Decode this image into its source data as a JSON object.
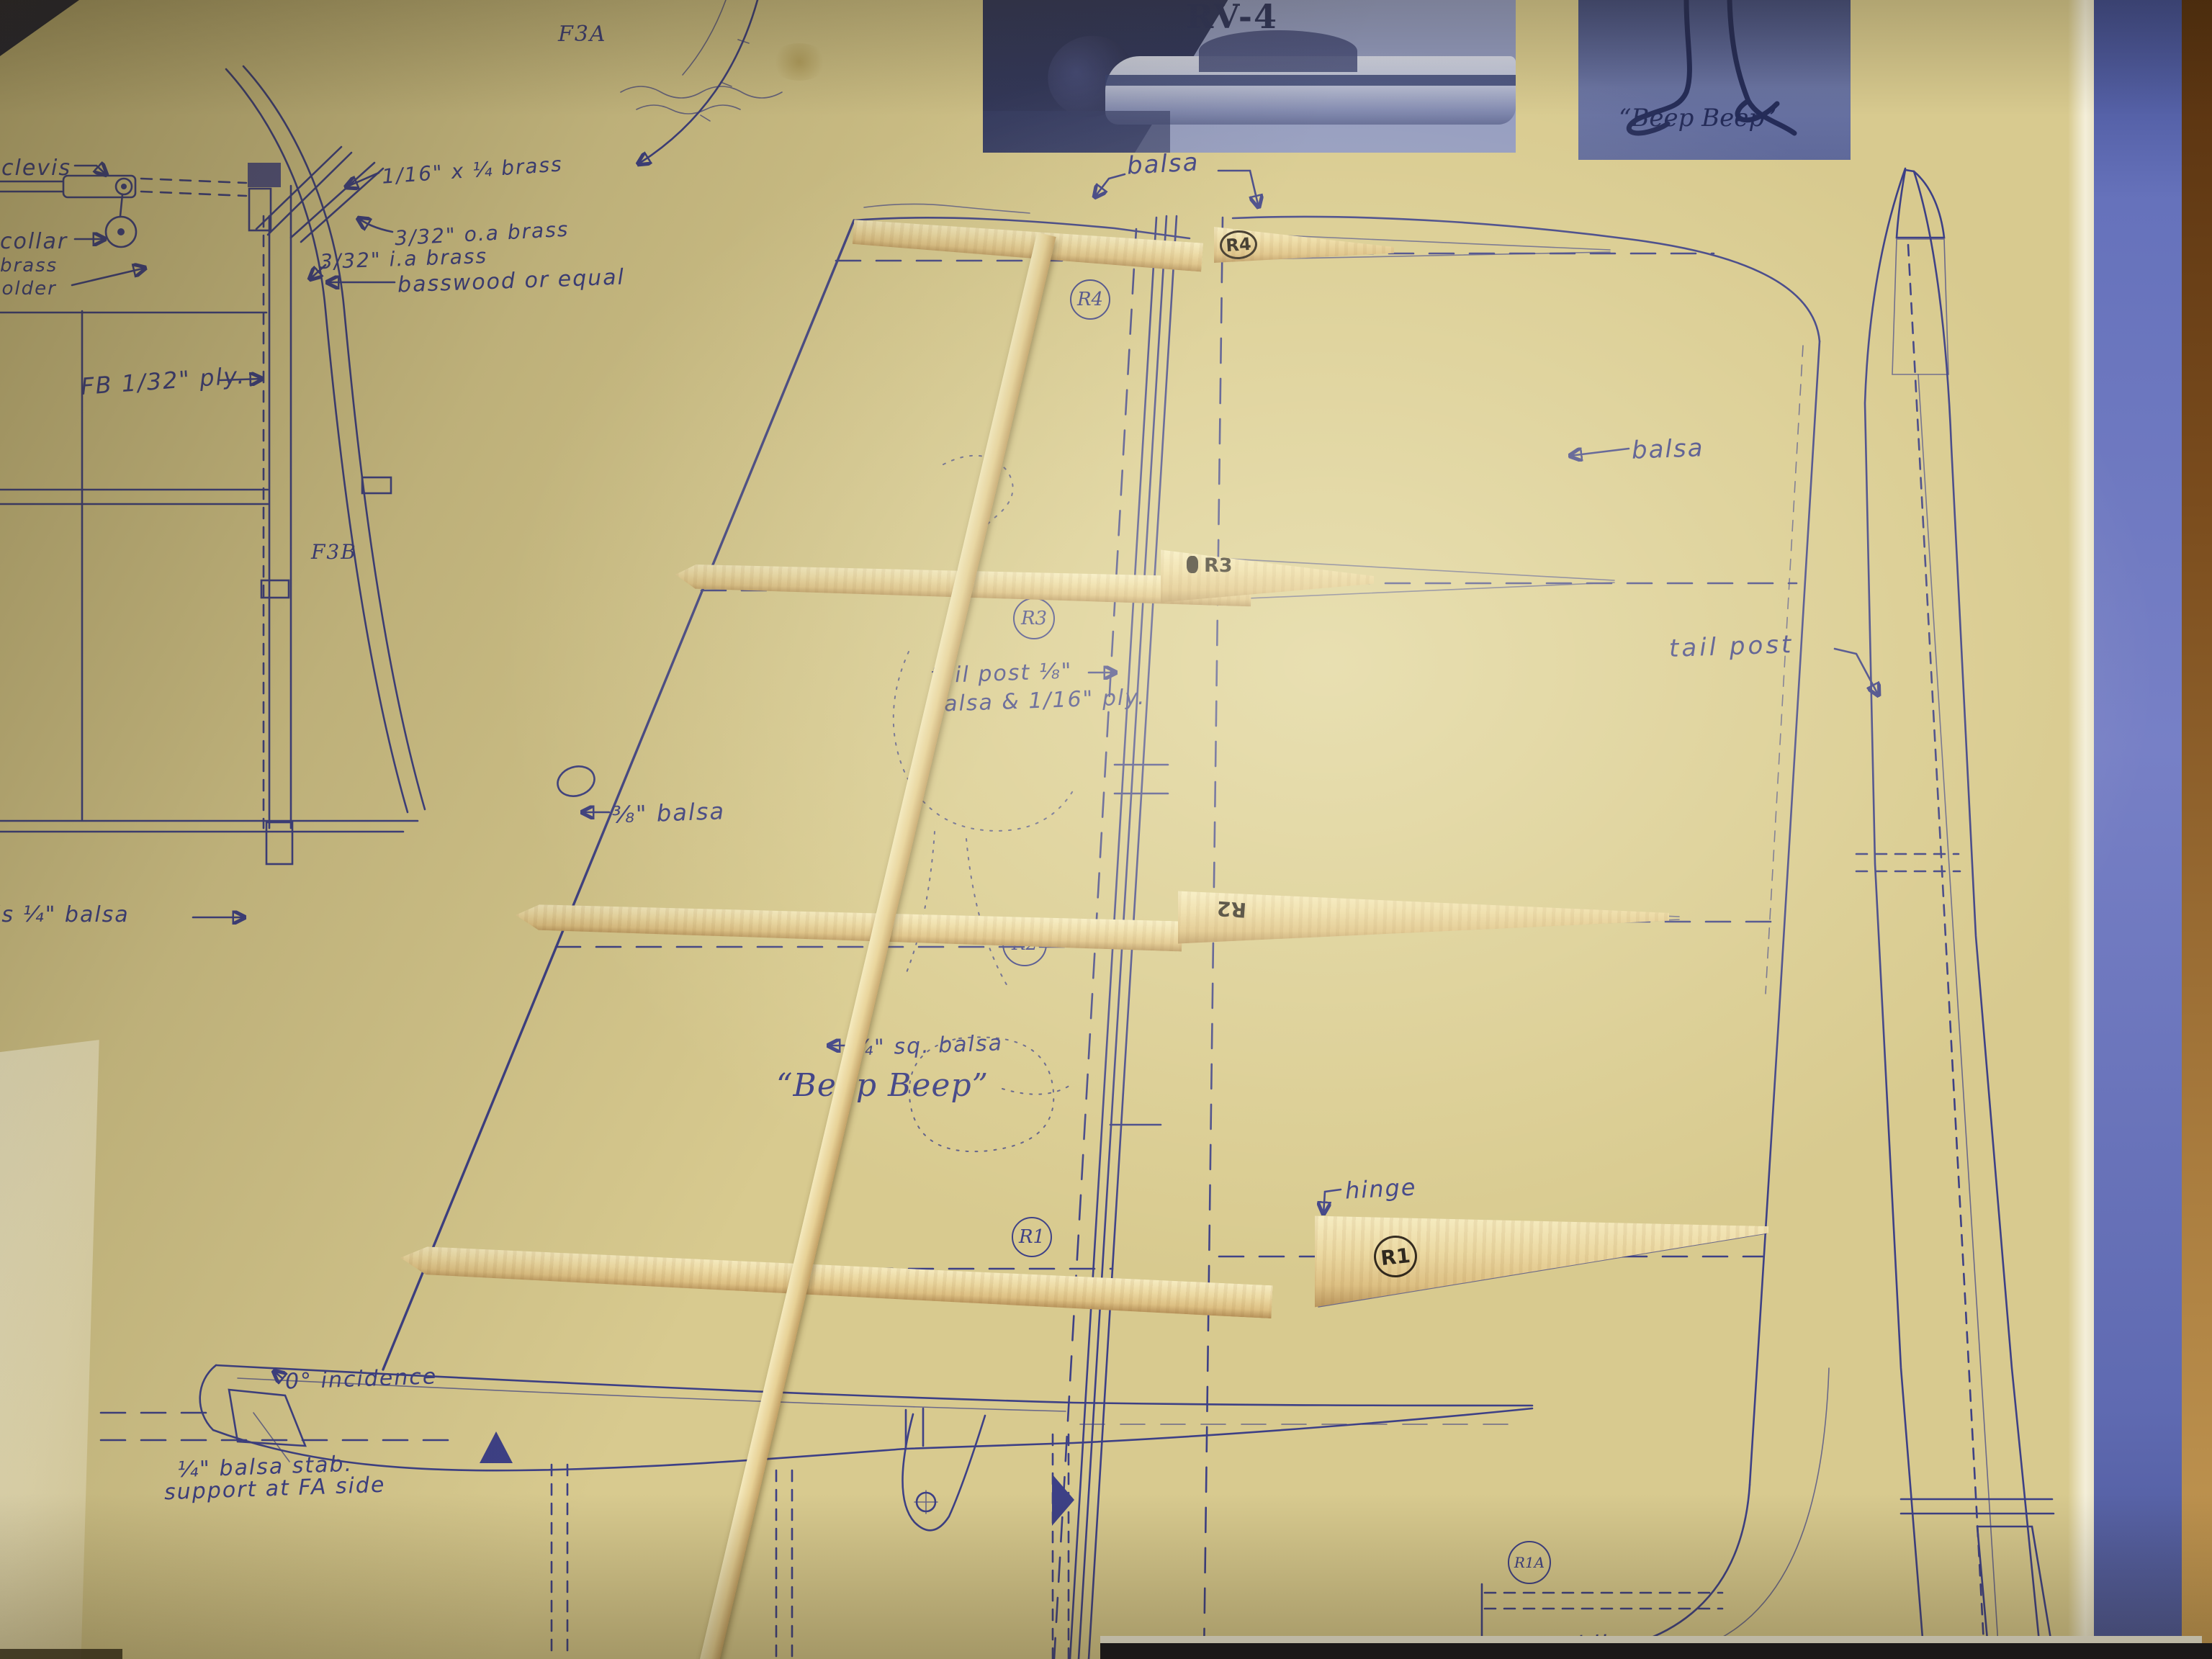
{
  "palette": {
    "paper": "#d8ca8f",
    "ink": "#3d4086",
    "wood": "#e8d6a2",
    "wood_shadow": "#b6925a",
    "blue_band": "#6673bd",
    "brown_edge": "#8a5a22",
    "photo_blue": "#99a2c4",
    "dark_bar": "#14141e",
    "cream_sheet": "#f2ebc6"
  },
  "photos": {
    "plane": {
      "caption": "RV-4"
    },
    "roadrunner": {
      "caption": "“Beep Beep”"
    }
  },
  "left_detail": {
    "clevis": "clevis",
    "collar": "collar",
    "brass1": "brass",
    "brass2": "holder",
    "brass_size1": "1/16\" x ¼ brass",
    "brass_size2": "3/32\" o.a brass",
    "brass_size3": "3/32\" i.a brass",
    "basswood": "basswood or equal",
    "ply": "FB 1/32\" ply.",
    "f3a": "F3A",
    "f3b": "F3B",
    "fus_side": "is ¼\" balsa"
  },
  "fin_plan": {
    "balsa": "balsa",
    "tailpost1": "tail post ⅛\"",
    "tailpost2": "balsa & 1/16\" ply.",
    "le_balsa": "⅜\" balsa",
    "sq_balsa": "¼\" sq. balsa",
    "script_name": "“Beep Beep”",
    "hinge": "hinge",
    "rib_r4": "R4",
    "rib_r3": "R3",
    "rib_r2": "R2",
    "rib_r1": "R1",
    "rib_r1a": "R1A"
  },
  "side_view": {
    "balsa": "balsa",
    "tail_post": "tail post",
    "balsa_blk": "balsa blk."
  },
  "stab": {
    "incidence": "0° incidence",
    "support1": "¼\" balsa stab.",
    "support2": "support at FA side"
  },
  "wood_parts": {
    "r4": "R4",
    "r3": "R3",
    "r2": "R2",
    "r1": "R1"
  }
}
